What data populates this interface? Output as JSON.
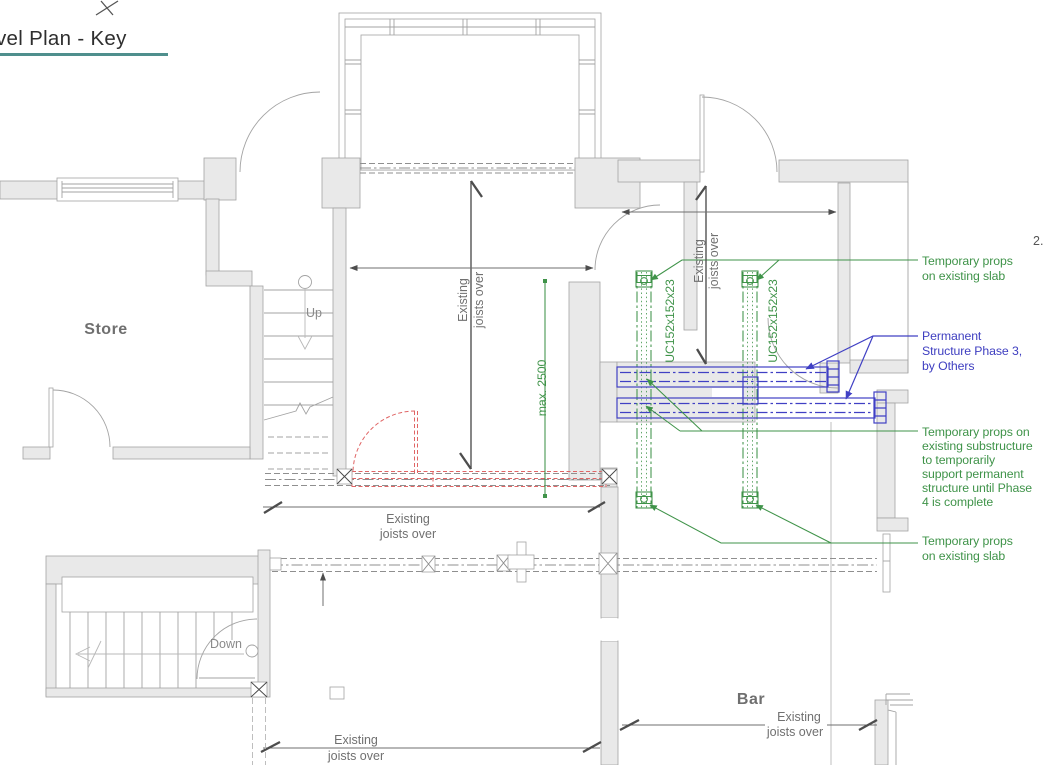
{
  "title": "vel Plan - Key",
  "sheet_note": "2.",
  "rooms": {
    "store": "Store",
    "bar": "Bar"
  },
  "stairs": {
    "up": "Up",
    "down": "Down"
  },
  "dims": {
    "joists": {
      "l1": "Existing",
      "l2": "joists over"
    },
    "max_span": "max. 2500"
  },
  "steel": {
    "uc_column": "UC152x152x23"
  },
  "annotations": {
    "props_slab_top": [
      "Temporary props",
      "on existing slab"
    ],
    "permanent_structure": [
      "Permanent",
      "Structure Phase 3,",
      "by Others"
    ],
    "props_substructure": [
      "Tempor​ary props on",
      "existing substructure",
      "to temporarily",
      "support permanent",
      "structure until Phase",
      "4 is complete"
    ],
    "props_slab_bottom": [
      "Temporary props",
      "on existing slab"
    ]
  },
  "colors": {
    "temporary_works_green": "#3f9349",
    "permanent_blue": "#4040c4",
    "demolition_red": "#e06565",
    "title_underline_teal": "#4f8f8d",
    "wall_fill": "#e9e9e9",
    "dimension_gray": "#4d4d4d"
  }
}
